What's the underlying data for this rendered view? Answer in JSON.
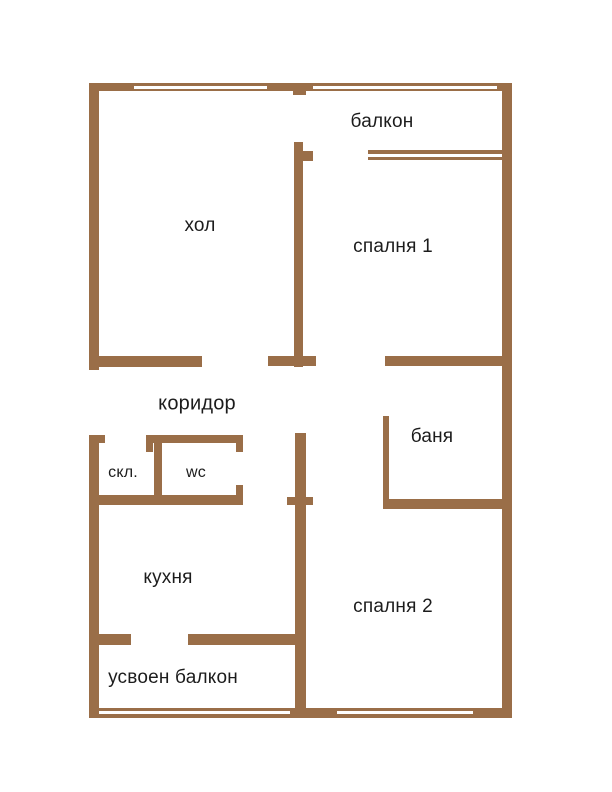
{
  "colors": {
    "wall": "#9A6E48",
    "window_gap": "#FFFFFF",
    "text": "#1C1C1C",
    "background": "#FFFFFF"
  },
  "plan": {
    "type": "apartment-floor-plan",
    "rooms": [
      {
        "id": "balkon",
        "label": "балкон"
      },
      {
        "id": "hol",
        "label": "хол"
      },
      {
        "id": "spalnya1",
        "label": "спалня 1"
      },
      {
        "id": "koridor",
        "label": "коридор"
      },
      {
        "id": "banya",
        "label": "баня"
      },
      {
        "id": "skl",
        "label": "скл."
      },
      {
        "id": "wc",
        "label": "wc"
      },
      {
        "id": "kuhnya",
        "label": "кухня"
      },
      {
        "id": "spalnya2",
        "label": "спалня 2"
      },
      {
        "id": "usvoen_balkon",
        "label": "усвоен балкон"
      }
    ]
  }
}
